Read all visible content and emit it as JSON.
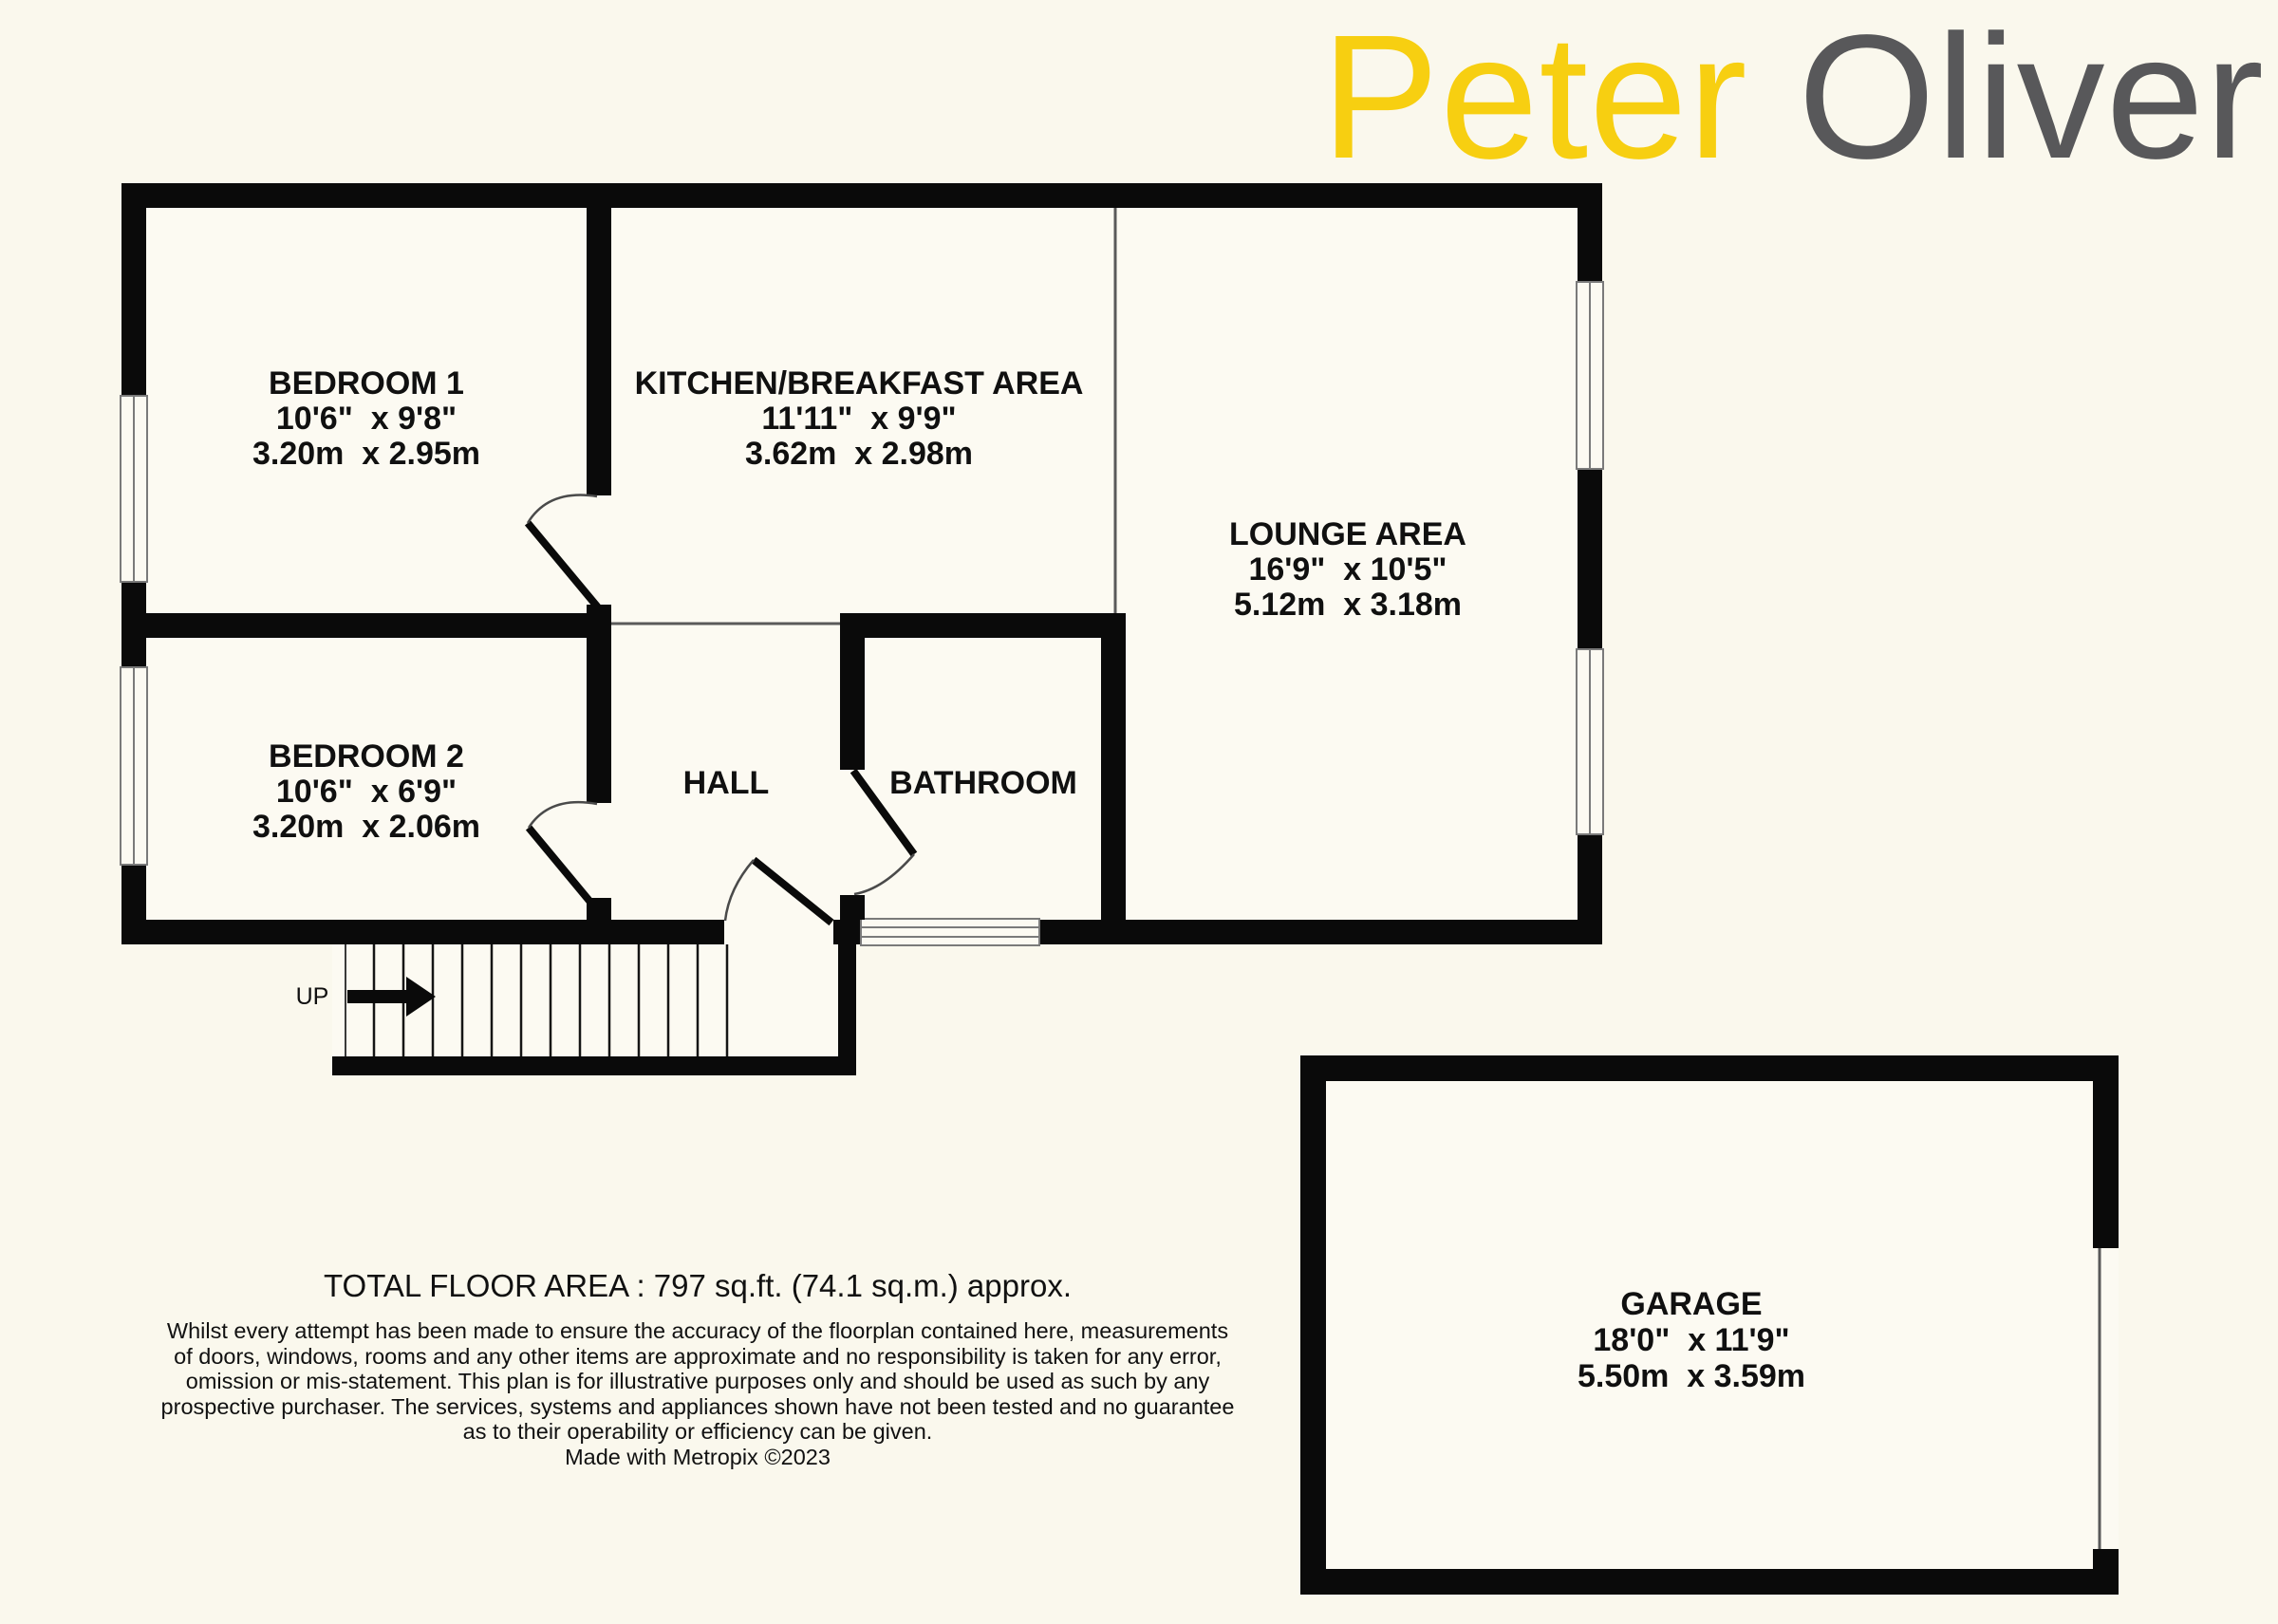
{
  "logo": {
    "first": "Peter",
    "second": "Oliver"
  },
  "rooms": {
    "bedroom1": {
      "name": "BEDROOM 1",
      "imperial": "10'6\"  x 9'8\"",
      "metric": "3.20m  x 2.95m"
    },
    "kitchen": {
      "name": "KITCHEN/BREAKFAST AREA",
      "imperial": "11'11\"  x 9'9\"",
      "metric": "3.62m  x 2.98m"
    },
    "lounge": {
      "name": "LOUNGE AREA",
      "imperial": "16'9\"  x 10'5\"",
      "metric": "5.12m  x 3.18m"
    },
    "bedroom2": {
      "name": "BEDROOM 2",
      "imperial": "10'6\"  x 6'9\"",
      "metric": "3.20m  x 2.06m"
    },
    "hall": {
      "name": "HALL"
    },
    "bathroom": {
      "name": "BATHROOM"
    },
    "garage": {
      "name": "GARAGE",
      "imperial": "18'0\"  x 11'9\"",
      "metric": "5.50m  x 3.59m"
    }
  },
  "stairs": {
    "label": "UP"
  },
  "footer": {
    "total_area": "TOTAL FLOOR AREA : 797 sq.ft. (74.1 sq.m.) approx.",
    "disclaimer_lines": [
      "Whilst every attempt has been made to ensure the accuracy of the floorplan contained here, measurements",
      "of doors, windows, rooms and any other items are approximate and no responsibility is taken for any error,",
      "omission or mis-statement. This plan is for illustrative purposes only and should be used as such by any",
      "prospective purchaser. The services, systems and appliances shown have not been tested and no guarantee",
      "as to their operability or efficiency can be given."
    ],
    "credit": "Made with Metropix ©2023"
  },
  "colors": {
    "background": "#FAF8ED",
    "wall": "#0A0A0A",
    "logo_yellow": "#F7CF11",
    "logo_gray": "#58585A"
  }
}
